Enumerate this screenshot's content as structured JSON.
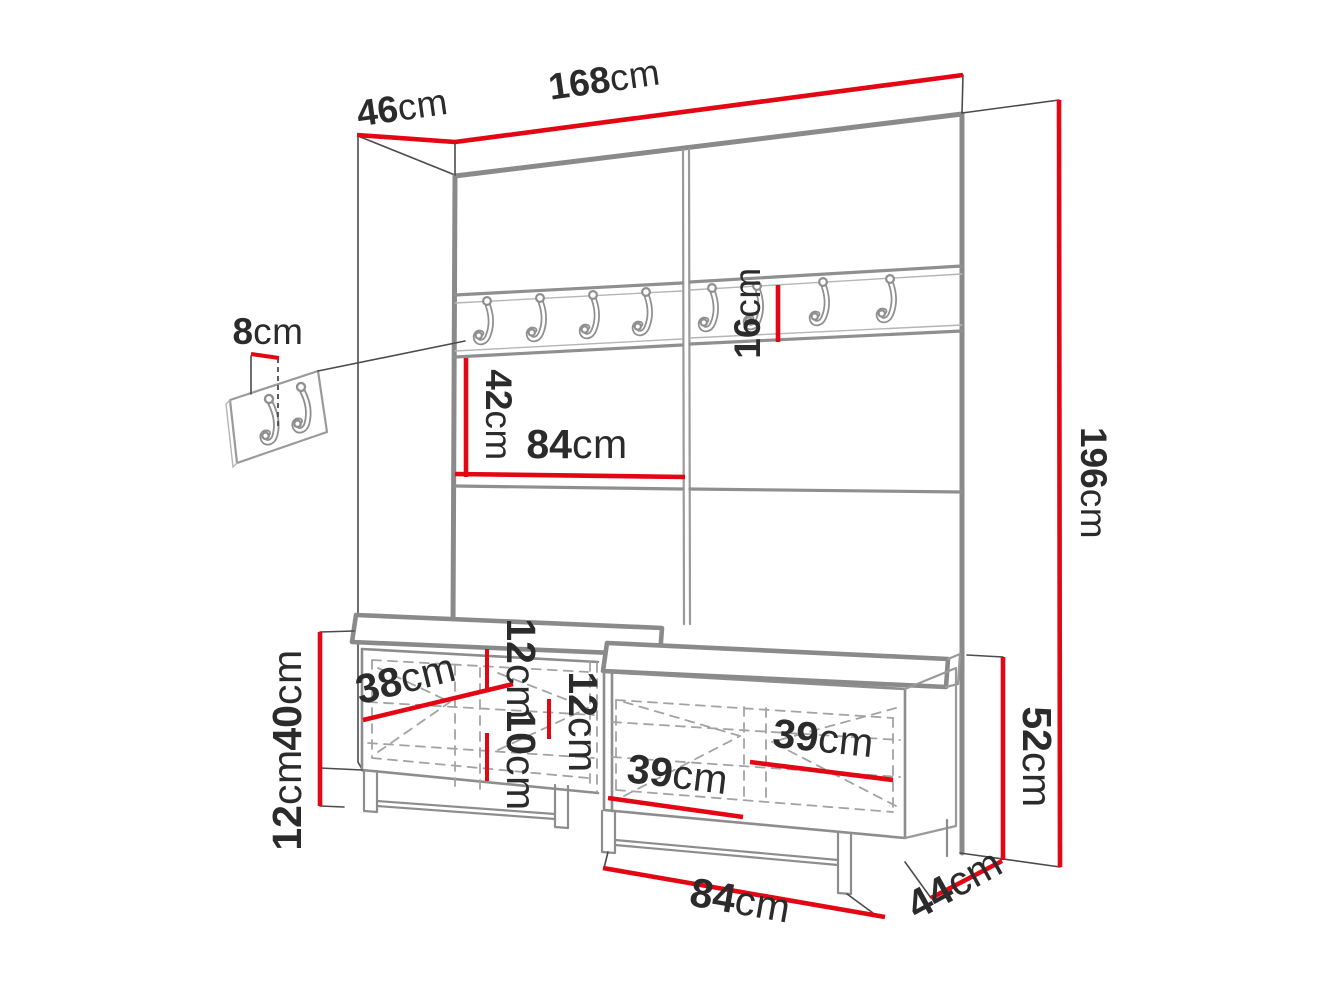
{
  "diagram": {
    "kind": "furniture-dimension-drawing",
    "subject": "hallway wardrobe wall panel with coat hooks, small hook panel and two shoe benches"
  },
  "colors": {
    "dimension_red": "#e30613",
    "outline_gray": "#8a8a8a",
    "hidden_gray": "#a3a3a3",
    "extension_dark": "#4b4b4b",
    "text": "#2b2b2b",
    "background": "#ffffff"
  },
  "hooks": {
    "main_row_total": 8,
    "main_row_left_half": 4,
    "main_row_right_half": 4,
    "small_panel_hooks": 2
  },
  "dimensions": {
    "total_width": {
      "num": "168",
      "unit": "cm"
    },
    "total_depth": {
      "num": "46",
      "unit": "cm"
    },
    "total_height": {
      "num": "196",
      "unit": "cm"
    },
    "small_panel_offset": {
      "num": "8",
      "unit": "cm"
    },
    "hook_rail_height": {
      "num": "16",
      "unit": "cm"
    },
    "open_section_height": {
      "num": "42",
      "unit": "cm"
    },
    "panel_half_width": {
      "num": "84",
      "unit": "cm"
    },
    "bench_interior_width": {
      "num": "38",
      "unit": "cm"
    },
    "bench_body_height": {
      "num": "40",
      "unit": "cm"
    },
    "leg_height": {
      "num": "12",
      "unit": "cm"
    },
    "shelf_gap_upper": {
      "num": "12",
      "unit": "cm"
    },
    "shelf_gap_lower": {
      "num": "10",
      "unit": "cm"
    },
    "shelf_gap_right": {
      "num": "12",
      "unit": "cm"
    },
    "compartment_left": {
      "num": "39",
      "unit": "cm"
    },
    "compartment_right": {
      "num": "39",
      "unit": "cm"
    },
    "bench_total_height": {
      "num": "52",
      "unit": "cm"
    },
    "bench_width": {
      "num": "84",
      "unit": "cm"
    },
    "bench_depth": {
      "num": "44",
      "unit": "cm"
    }
  }
}
